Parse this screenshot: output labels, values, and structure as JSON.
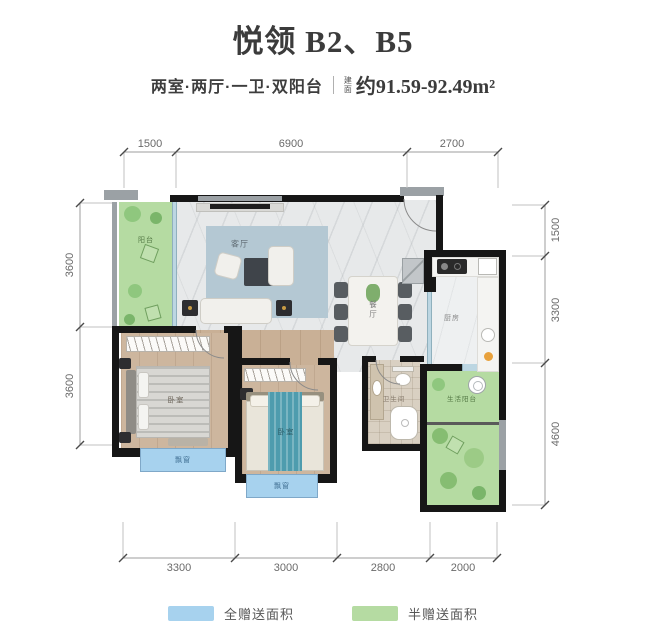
{
  "header": {
    "title": "悦领 B2、B5",
    "layout": "两室·两厅·一卫·双阳台",
    "area_label": "建面",
    "area_value": "约91.59-92.49m²"
  },
  "dimensions": {
    "top": [
      "1500",
      "6900",
      "2700"
    ],
    "left": [
      "3600",
      "3600"
    ],
    "right": [
      "1500",
      "3300",
      "4600"
    ],
    "bottom": [
      "3300",
      "3000",
      "2800",
      "2000"
    ]
  },
  "rooms": {
    "balcony": {
      "label": "阳台"
    },
    "living": {
      "label": "客厅"
    },
    "dining": {
      "label": "餐厅"
    },
    "kitchen": {
      "label": "厨房"
    },
    "bedroom_master": {
      "label": "卧室"
    },
    "bedroom_second": {
      "label": "卧室"
    },
    "bathroom": {
      "label": "卫生间"
    },
    "life_balcony": {
      "label": "生活阳台"
    },
    "bay_window_1": {
      "label": "飘窗"
    },
    "bay_window_2": {
      "label": "飘窗"
    }
  },
  "legend": {
    "items": [
      {
        "label": "全赠送面积",
        "color": "#a7d2ee"
      },
      {
        "label": "半赠送面积",
        "color": "#b5dba2"
      }
    ]
  },
  "colors": {
    "wall": "#161616",
    "full_gift_blue": "#a7d2ee",
    "half_gift_green": "#b5dba2",
    "title_text": "#3b3b3b"
  }
}
